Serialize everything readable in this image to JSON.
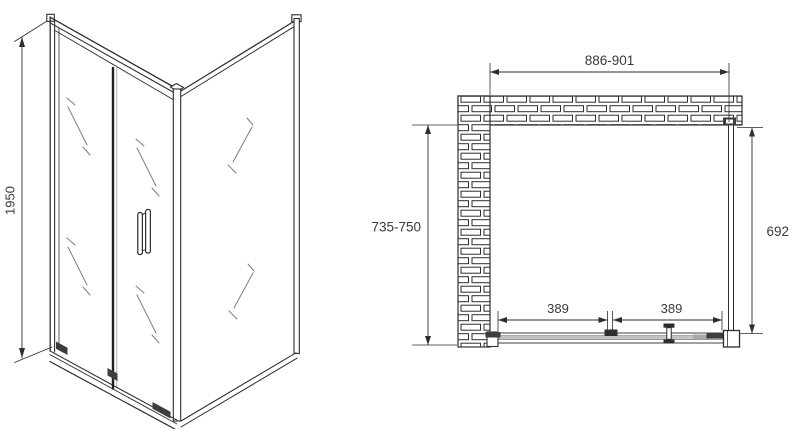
{
  "drawing": {
    "title": "shower-enclosure-technical-drawing",
    "colors": {
      "line": "#2e2e2e",
      "background": "#ffffff",
      "glass_mark": "#7d7d7d",
      "track_fill": "#c3c3c3",
      "dark_fitting": "#3d3d3d"
    }
  },
  "iso_view": {
    "height_dim": "1950"
  },
  "plan_view": {
    "width_dim": "886-901",
    "depth_dim": "735-750",
    "panel_dim": "692",
    "door_left_dim": "389",
    "door_right_dim": "389"
  }
}
